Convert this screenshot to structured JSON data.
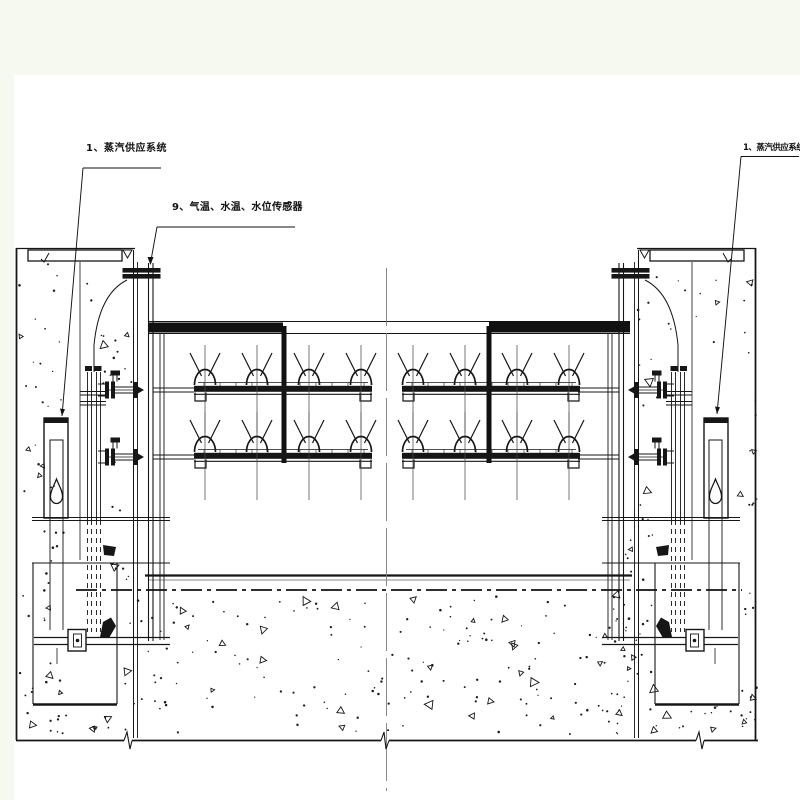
{
  "page": {
    "background": "#f6f9f0",
    "paper": "#ffffff",
    "line_color": "#161616",
    "centerline_color": "#7d7d7d"
  },
  "drawing": {
    "kind": "steam-heating-gate-elevation",
    "annotations": [
      {
        "id": "steam-supply-left",
        "text": "1、蒸汽供应系统"
      },
      {
        "id": "temp-water-level-sensors",
        "text": "9、气温、水温、水位传感器"
      },
      {
        "id": "steam-supply-right",
        "text": "1、蒸汽供应系统"
      }
    ]
  }
}
